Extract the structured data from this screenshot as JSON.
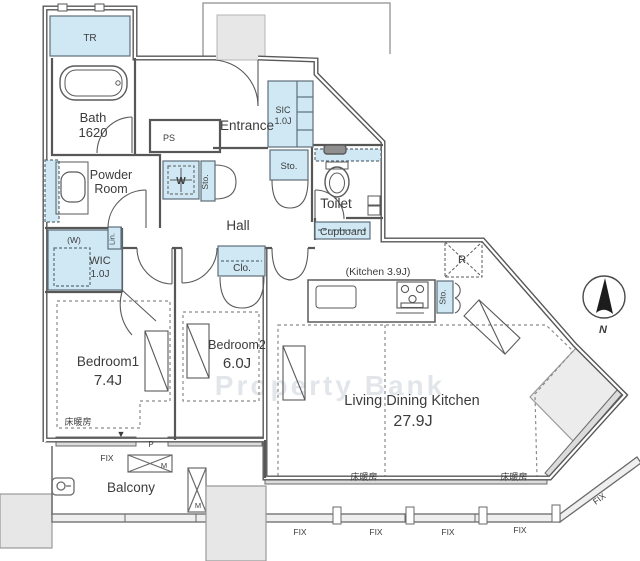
{
  "plan": {
    "watermark": "Property Bank",
    "compass": {
      "north": "N"
    },
    "rooms": {
      "tr": {
        "name": "TR"
      },
      "bath": {
        "name": "Bath",
        "size": "1620"
      },
      "ps": {
        "name": "PS"
      },
      "entrance": {
        "name": "Entrance"
      },
      "sic": {
        "name": "SIC",
        "size": "1.0J"
      },
      "toilet": {
        "name": "Toilet"
      },
      "cupboard": {
        "name": "Cupboard"
      },
      "powder_room": {
        "line1": "Powder",
        "line2": "Room"
      },
      "washer": {
        "symbol": "W",
        "alt": "(W)"
      },
      "lin": {
        "name": "Lin."
      },
      "wic": {
        "name": "WIC",
        "size": "1.0J"
      },
      "hall": {
        "name": "Hall"
      },
      "clo": {
        "name": "Clo."
      },
      "bedroom1": {
        "name": "Bedroom1",
        "size": "7.4J"
      },
      "bedroom2": {
        "name": "Bedroom2",
        "size": "6.0J"
      },
      "kitchen": {
        "name": "(Kitchen  3.9J)"
      },
      "ldk": {
        "name": "Living Dining Kitchen",
        "size": "27.9J"
      },
      "fridge": {
        "symbol": "R"
      },
      "balcony": {
        "name": "Balcony"
      }
    },
    "labels": {
      "sto": "Sto.",
      "fix": "FIX",
      "p": "P",
      "m": "M",
      "floor_heating": "床暖房",
      "down_marker": "▼"
    },
    "colors": {
      "storage_fill": "#cfe8f4",
      "wall": "#575757",
      "gray_fill": "#e9e9e9",
      "text": "#3c3c3c",
      "watermark": "#ccd3da"
    }
  }
}
